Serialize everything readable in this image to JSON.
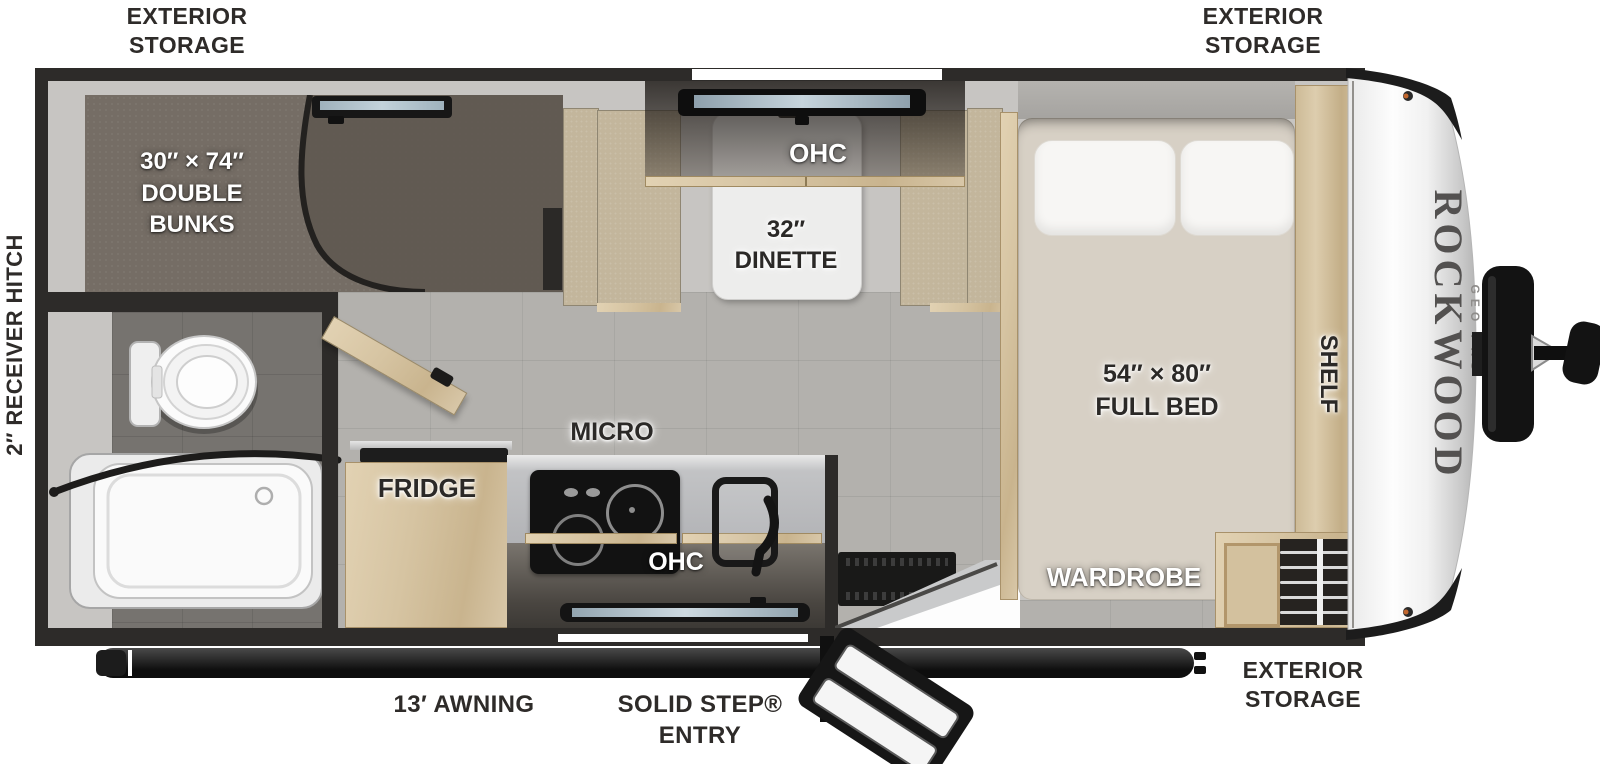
{
  "meta": {
    "title": "Rockwood Geo Pro travel trailer floorplan"
  },
  "brand": {
    "name": "ROCKWOOD",
    "model": "GEO PRO"
  },
  "exterior": {
    "storage_line1": "EXTERIOR",
    "storage_line2": "STORAGE",
    "receiver_hitch": "2″ RECEIVER HITCH",
    "awning": "13′ AWNING",
    "entry_line1": "SOLID STEP®",
    "entry_line2": "ENTRY"
  },
  "rooms": {
    "bunks": {
      "line1": "30″ × 74″",
      "line2": "DOUBLE",
      "line3": "BUNKS"
    },
    "dinette": {
      "ohc": "OHC",
      "line1": "32″",
      "line2": "DINETTE"
    },
    "kitchen": {
      "micro": "MICRO",
      "fridge": "FRIDGE",
      "ohc": "OHC"
    },
    "bedroom": {
      "line1": "54″ × 80″",
      "line2": "FULL BED",
      "shelf": "SHELF",
      "wardrobe": "WARDROBE"
    }
  },
  "colors": {
    "wall": "#2d2b29",
    "wood": "#d8c6a6",
    "carpet": "#756d65",
    "floor_tile": "#b3b1ad",
    "bench": "#c3b69c",
    "marker_light": "#c2672e"
  }
}
